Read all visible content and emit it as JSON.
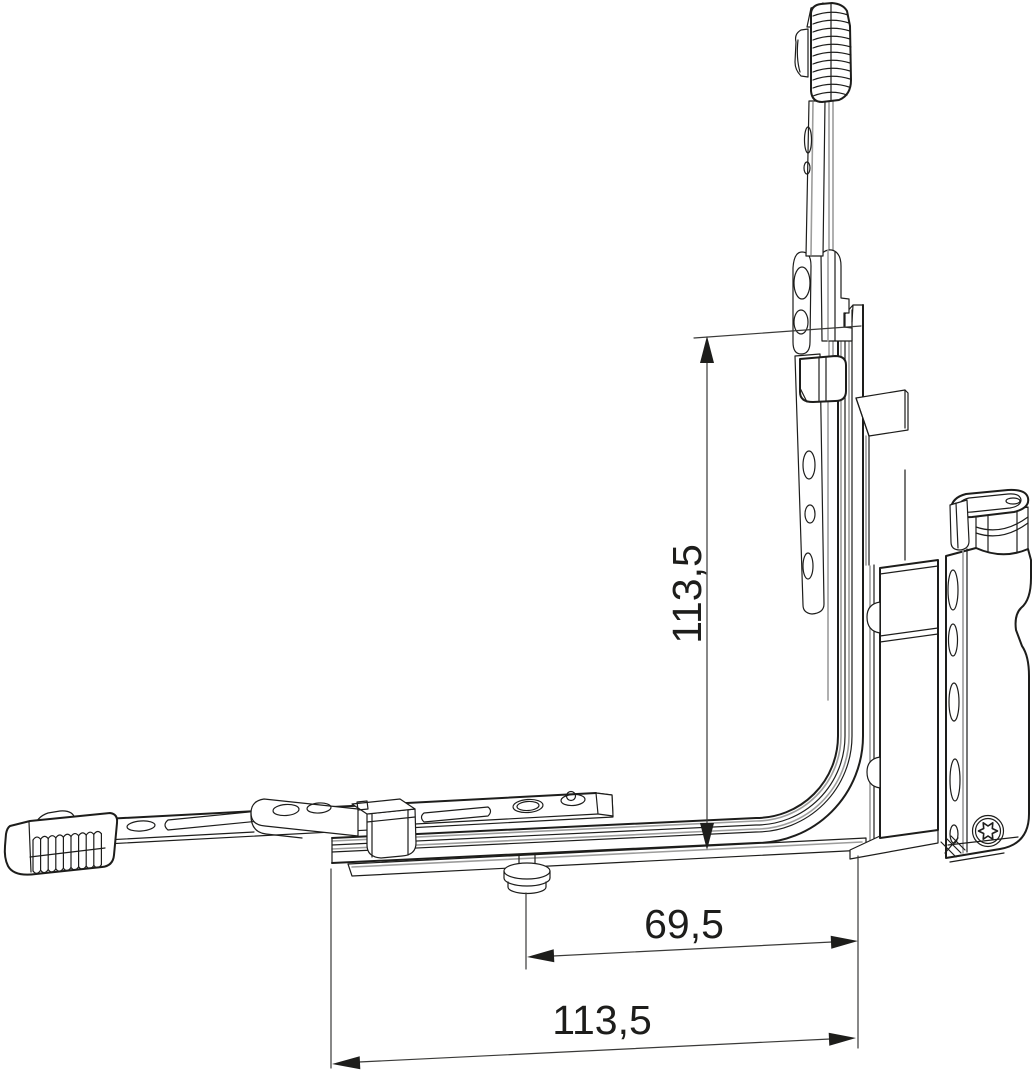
{
  "drawing": {
    "colors": {
      "background": "#ffffff",
      "line": "#1d1d1b",
      "secondary_line": "#9d9d9c",
      "dimension": "#3a3a38"
    },
    "dimensions": {
      "vertical": {
        "label": "113,5"
      },
      "horizontal_inner": {
        "label": "69,5"
      },
      "horizontal_outer": {
        "label": "113,5"
      }
    }
  }
}
